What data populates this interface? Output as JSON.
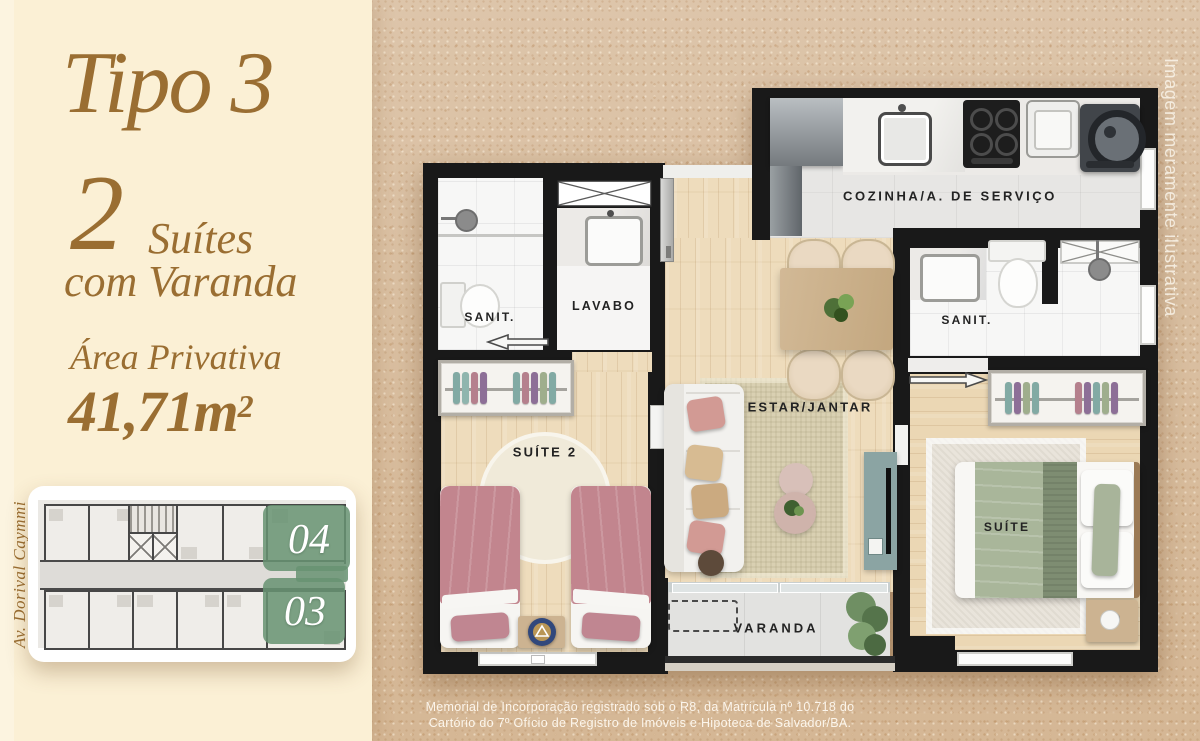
{
  "panel": {
    "title": "Tipo 3",
    "suites": {
      "count": "2",
      "label": "Suítes",
      "sub": "com Varanda"
    },
    "area": {
      "label": "Área Privativa",
      "value": "41,71m",
      "sup": "2"
    },
    "street": "Av. Dorival Caymmi"
  },
  "keyplan": {
    "unit_top": "04",
    "unit_bottom": "03",
    "highlight_color": "#689372"
  },
  "rooms": {
    "sanit_left": "SANIT.",
    "lavabo": "LAVABO",
    "cozinha": "COZINHA/A. DE SERVIÇO",
    "sanit_right": "SANIT.",
    "suite2": "SUÍTE 2",
    "estar": "ESTAR/JANTAR",
    "suite": "SUÍTE",
    "varanda": "VARANDA"
  },
  "watermark": "Imagem meramente ilustrativa",
  "disclaimer": {
    "line1": "Memorial de Incorporação registrado sob o R8, da Matrícula nº 10.718 do",
    "line2": "Cartório do 7º Ofício de Registro de Imóveis e Hipoteca de Salvador/BA."
  },
  "colors": {
    "accent_brown": "#9a6e32",
    "panel_cream": "#fbf0d5",
    "sand": "#dcc3a6"
  }
}
